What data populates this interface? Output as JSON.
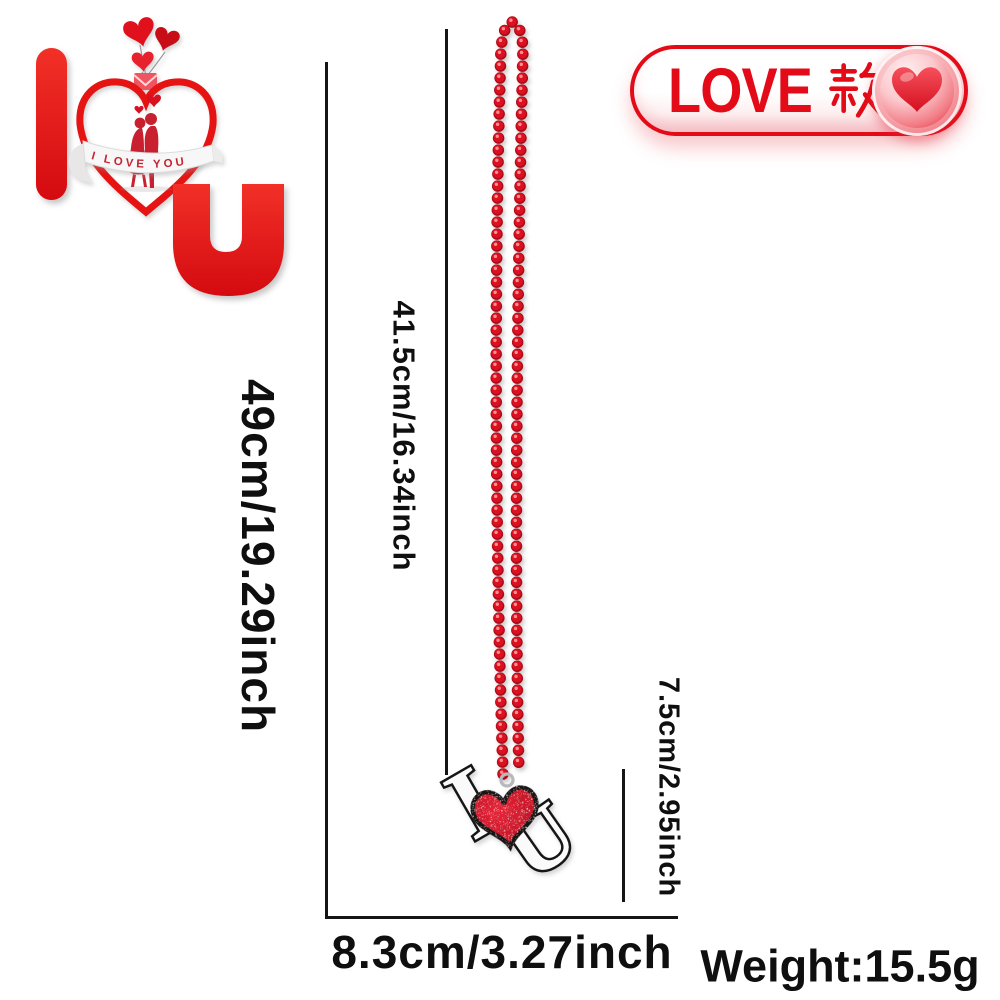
{
  "page": {
    "background": "#ffffff"
  },
  "logo": {
    "letter_i": "I",
    "letter_u": "U",
    "ribbon_text": "I LOVE YOU"
  },
  "badge": {
    "label": "LOVE款",
    "latin_part": "LOVE",
    "cjk_part": "款",
    "heart_icon": "heart",
    "text_color": "#e30b17"
  },
  "necklace": {
    "description": "red bead chain necklace",
    "pendant": {
      "letter_i": "I",
      "letter_u": "U",
      "heart_icon": "glitter-heart"
    },
    "bead_color": "#d8101f"
  },
  "measurements": {
    "total_length": "49cm/19.29inch",
    "chain_drop": "41.5cm/16.34inch",
    "pendant_height": "7.5cm/2.95inch",
    "pendant_width": "8.3cm/3.27inch",
    "weight": "Weight:15.5g"
  },
  "colors": {
    "accent_red": "#e30b17",
    "bead_red": "#d8101f",
    "line_black": "#151515"
  }
}
